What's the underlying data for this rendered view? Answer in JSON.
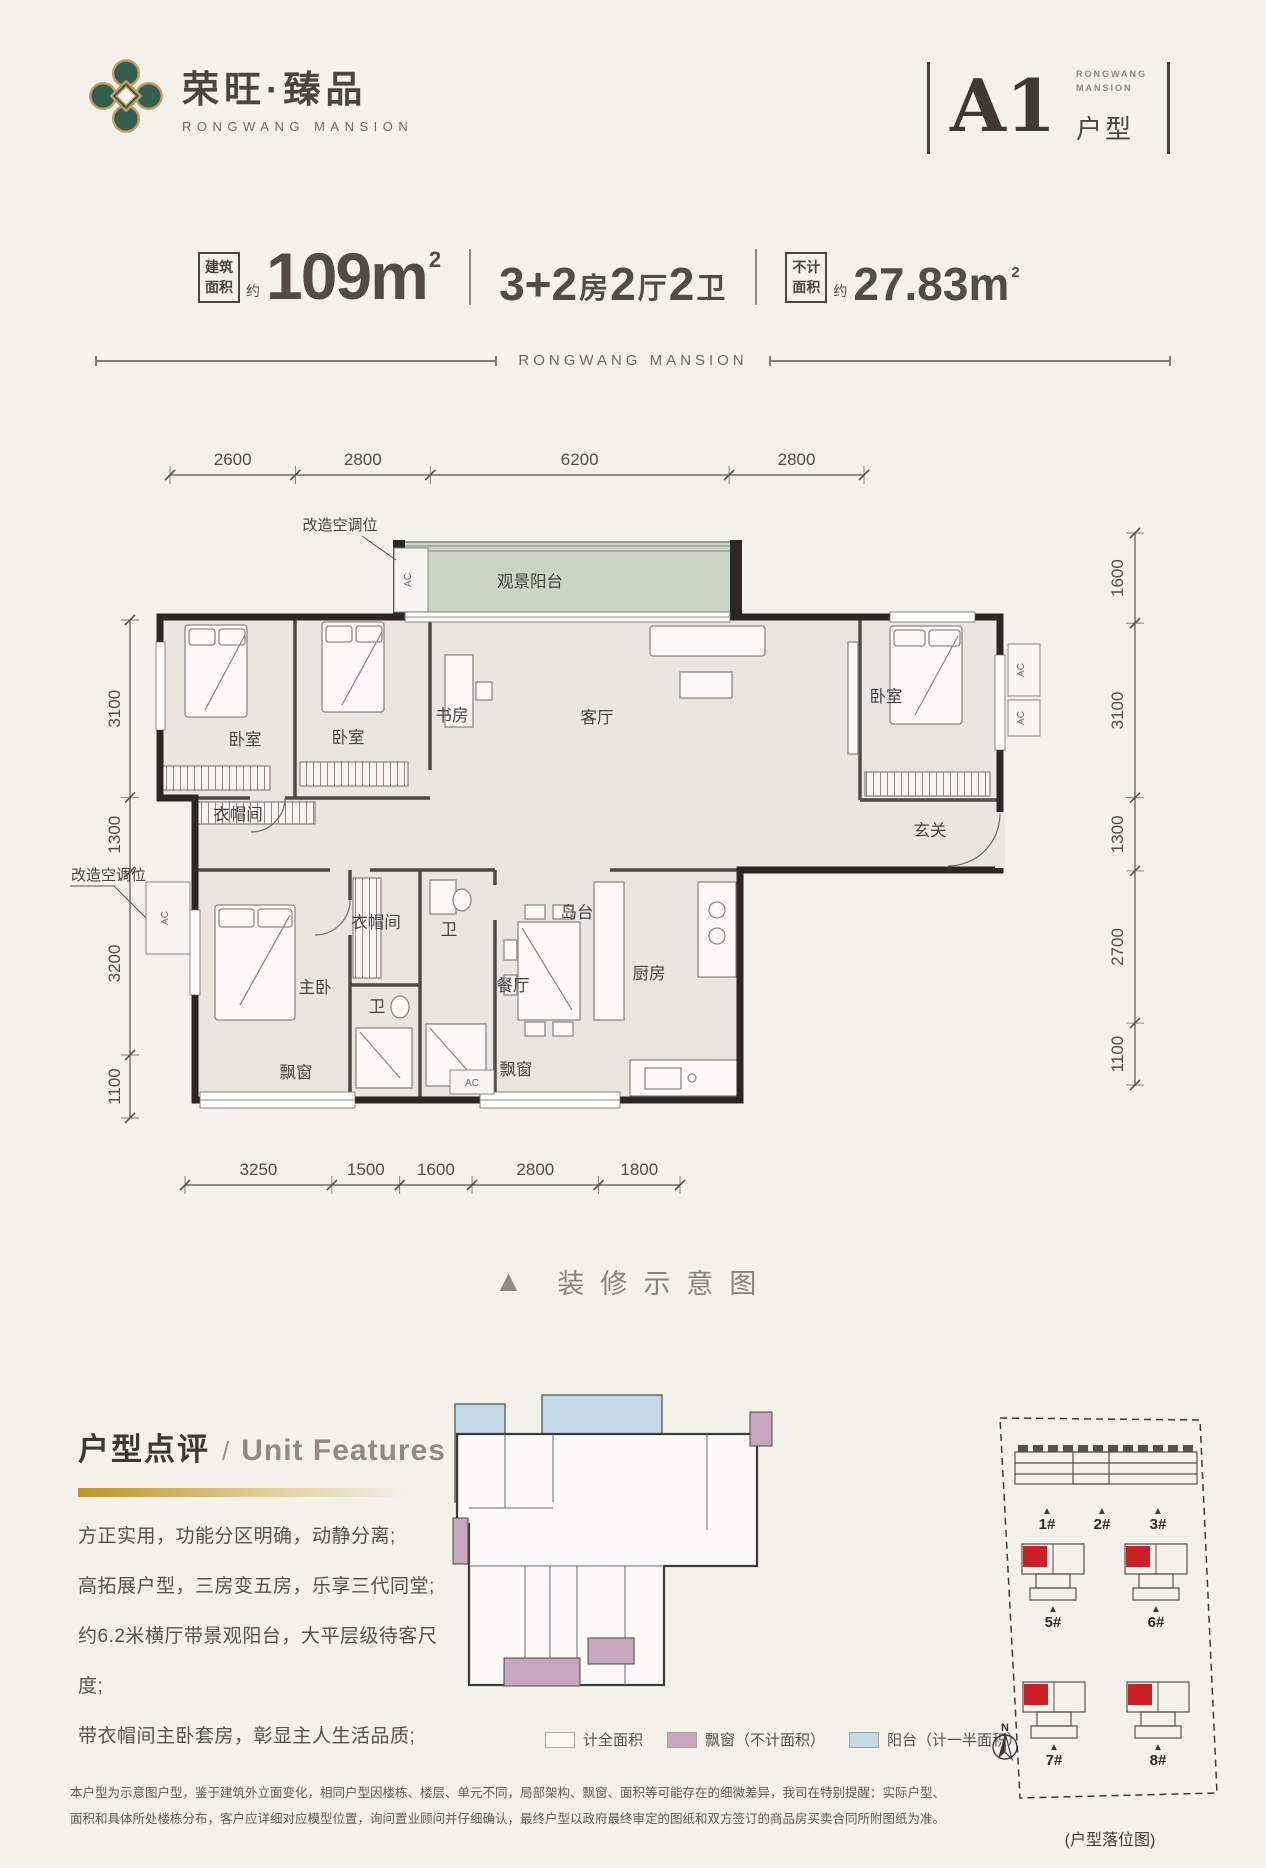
{
  "brand": {
    "logo_cn": "荣旺·臻品",
    "logo_en": "RONGWANG MANSION"
  },
  "unit_badge": {
    "code": "A1",
    "type_label": "户型",
    "sub_line1": "RONGWANG",
    "sub_line2": "MANSION"
  },
  "specs": {
    "build_label_l1": "建筑",
    "build_label_l2": "面积",
    "approx": "约",
    "area_value": "109m",
    "area_sup": "2",
    "layout_segments": [
      {
        "t": "3+2",
        "big": true
      },
      {
        "t": "房",
        "big": false
      },
      {
        "t": "2",
        "big": true
      },
      {
        "t": "厅",
        "big": false
      },
      {
        "t": "2",
        "big": true
      },
      {
        "t": "卫",
        "big": false
      }
    ],
    "excl_label_l1": "不计",
    "excl_label_l2": "面积",
    "excl_approx": "约",
    "excl_value": "27.83m",
    "excl_sup": "2"
  },
  "divider_text": "RONGWANG MANSION",
  "caption": {
    "marker": "▲",
    "text": "装修示意图"
  },
  "floorplan": {
    "dims_top": [
      "2600",
      "2800",
      "6200",
      "2800"
    ],
    "dims_bottom": [
      "3250",
      "1500",
      "1600",
      "2800",
      "1800"
    ],
    "dims_left": [
      "3100",
      "1300",
      "3200",
      "1100"
    ],
    "dims_right": [
      "1600",
      "3100",
      "1300",
      "2700",
      "1100"
    ],
    "ac_text": "AC",
    "ac_labels": [
      {
        "label": "改造空调位",
        "x": 240,
        "y": 100,
        "anchor": "middle"
      },
      {
        "label": "改造空调位",
        "x": 46,
        "y": 450,
        "anchor": "end"
      }
    ],
    "rooms": [
      {
        "label": "观景阳台",
        "x": 430,
        "y": 157
      },
      {
        "label": "卧室",
        "x": 145,
        "y": 315
      },
      {
        "label": "卧室",
        "x": 248,
        "y": 313
      },
      {
        "label": "书房",
        "x": 352,
        "y": 291
      },
      {
        "label": "客厅",
        "x": 497,
        "y": 293
      },
      {
        "label": "卧室",
        "x": 786,
        "y": 272
      },
      {
        "label": "衣帽间",
        "x": 138,
        "y": 390
      },
      {
        "label": "玄关",
        "x": 830,
        "y": 406
      },
      {
        "label": "主卧",
        "x": 215,
        "y": 563
      },
      {
        "label": "衣帽间",
        "x": 276,
        "y": 498
      },
      {
        "label": "卫",
        "x": 349,
        "y": 505
      },
      {
        "label": "卫",
        "x": 277,
        "y": 582
      },
      {
        "label": "餐厅",
        "x": 413,
        "y": 561
      },
      {
        "label": "岛台",
        "x": 477,
        "y": 488
      },
      {
        "label": "厨房",
        "x": 549,
        "y": 549
      },
      {
        "label": "飘窗",
        "x": 196,
        "y": 648
      },
      {
        "label": "飘窗",
        "x": 416,
        "y": 645
      }
    ]
  },
  "features": {
    "title_cn": "户型点评",
    "title_sep": "/",
    "title_en": "Unit Features",
    "items": [
      "方正实用，功能分区明确，动静分离;",
      "高拓展户型，三房变五房，乐享三代同堂;",
      "约6.2米横厅带景观阳台，大平层级待客尺度;",
      "带衣帽间主卧套房，彰显主人生活品质;"
    ]
  },
  "legend": [
    {
      "label": "计全面积",
      "color": "#fcfbf6"
    },
    {
      "label": "飘窗（不计面积）",
      "color": "#c7a6bd"
    },
    {
      "label": "阳台（计一半面积）",
      "color": "#c3d9e8"
    }
  ],
  "siteplan": {
    "row_buildings": [
      "1#",
      "2#",
      "3#"
    ],
    "towers": [
      "5#",
      "6#",
      "7#",
      "8#"
    ],
    "marker": "▲",
    "north_label": "N",
    "caption": "(户型落位图)"
  },
  "disclaimer": [
    "本户型为示意图户型，鉴于建筑外立面变化，相同户型因楼栋、楼层、单元不同，局部架构、飘窗、面积等可能存在的细微差异，我司在特别提醒：实际户型、",
    "面积和具体所处楼栋分布，客户应详细对应模型位置，询问置业顾问并仔细确认，最终户型以政府最终审定的图纸和双方签订的商品房买卖合同所附图纸为准。"
  ],
  "colors": {
    "accent_gold": "#bd9428",
    "highlight_red": "#cc2027",
    "bay_window_mauve": "#c7a6bd",
    "balcony_blue": "#c3d9e8",
    "balcony_green": "#cbd5c5",
    "wall_dark": "#2d2723"
  }
}
